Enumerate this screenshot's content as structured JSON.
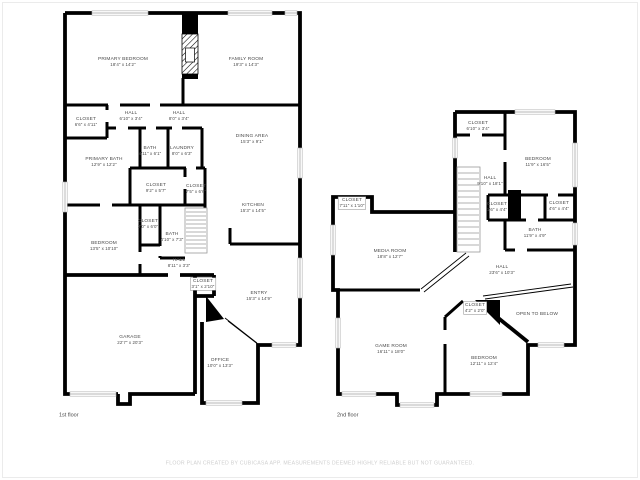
{
  "canvas": {
    "background": "#ffffff",
    "wall_color": "#000000",
    "label_color": "#4a4a4a",
    "footer_color": "#cfcfcf"
  },
  "footer": {
    "disclaimer": "FLOOR PLAN CREATED BY CUBICASA APP. MEASUREMENTS DEEMED HIGHLY RELIABLE BUT NOT GUARANTEED."
  },
  "floors": [
    {
      "id": "first-floor",
      "label": "1st floor",
      "label_pos": {
        "x": 59,
        "y": 412
      },
      "rooms": [
        {
          "name": "PRIMARY BEDROOM",
          "dims": "18'4\" x 14'2\"",
          "x": 123,
          "y": 62
        },
        {
          "name": "FAMILY ROOM",
          "dims": "19'3\" x 14'3\"",
          "x": 246,
          "y": 62
        },
        {
          "name": "CLOSET",
          "dims": "6'6\" x 4'11\"",
          "x": 86,
          "y": 122
        },
        {
          "name": "HALL",
          "dims": "6'10\" x 3'4\"",
          "x": 131,
          "y": 116
        },
        {
          "name": "HALL",
          "dims": "8'0\" x 3'4\"",
          "x": 179,
          "y": 116
        },
        {
          "name": "DINING AREA",
          "dims": "15'3\" x 9'1\"",
          "x": 252,
          "y": 139
        },
        {
          "name": "PRIMARY BATH",
          "dims": "12'9\" x 12'2\"",
          "x": 104,
          "y": 162
        },
        {
          "name": "BATH",
          "dims": "4'11\" x 6'1\"",
          "x": 150,
          "y": 151
        },
        {
          "name": "LAUNDRY",
          "dims": "8'0\" x 6'3\"",
          "x": 182,
          "y": 151
        },
        {
          "name": "CLOSET",
          "dims": "9'2\" x 5'7\"",
          "x": 156,
          "y": 188
        },
        {
          "name": "CLOSET",
          "dims": "7'5\" x 6'6\"",
          "x": 196,
          "y": 189
        },
        {
          "name": "KITCHEN",
          "dims": "15'3\" x 14'5\"",
          "x": 253,
          "y": 208
        },
        {
          "name": "BEDROOM",
          "dims": "13'5\" x 10'10\"",
          "x": 104,
          "y": 246
        },
        {
          "name": "CLOSET",
          "dims": "2'0\" x 6'0\"",
          "x": 148,
          "y": 224
        },
        {
          "name": "BATH",
          "dims": "4'10\" x 7'3\"",
          "x": 172,
          "y": 237
        },
        {
          "name": "HALL",
          "dims": "8'11\" x 3'3\"",
          "x": 179,
          "y": 263
        },
        {
          "name": "CLOSET",
          "dims": "3'1\" x 2'10\"",
          "x": 203,
          "y": 284,
          "boxed": true
        },
        {
          "name": "ENTRY",
          "dims": "15'3\" x 14'9\"",
          "x": 259,
          "y": 296
        },
        {
          "name": "GARAGE",
          "dims": "22'7\" x 20'3\"",
          "x": 130,
          "y": 340
        },
        {
          "name": "OFFICE",
          "dims": "10'0\" x 13'3\"",
          "x": 220,
          "y": 363
        }
      ]
    },
    {
      "id": "second-floor",
      "label": "2nd floor",
      "label_pos": {
        "x": 337,
        "y": 412
      },
      "rooms": [
        {
          "name": "CLOSET",
          "dims": "6'10\" x 3'4\"",
          "x": 478,
          "y": 126
        },
        {
          "name": "BEDROOM",
          "dims": "11'9\" x 16'5\"",
          "x": 538,
          "y": 162
        },
        {
          "name": "HALL",
          "dims": "9'10\" x 18'1\"",
          "x": 490,
          "y": 181
        },
        {
          "name": "CLOSET",
          "dims": "1'6\" x 4'4\"",
          "x": 497,
          "y": 207
        },
        {
          "name": "CLOSET",
          "dims": "4'6\" x 4'4\"",
          "x": 559,
          "y": 206
        },
        {
          "name": "BATH",
          "dims": "11'9\" x 4'9\"",
          "x": 535,
          "y": 233
        },
        {
          "name": "CLOSET",
          "dims": "7'11\" x 1'10\"",
          "x": 352,
          "y": 203,
          "boxed": true
        },
        {
          "name": "MEDIA ROOM",
          "dims": "18'8\" x 12'7\"",
          "x": 390,
          "y": 254
        },
        {
          "name": "HALL",
          "dims": "23'6\" x 10'3\"",
          "x": 502,
          "y": 270
        },
        {
          "name": "CLOSET",
          "dims": "4'2\" x 2'0\"",
          "x": 475,
          "y": 308,
          "boxed": true
        },
        {
          "name": "OPEN TO BELOW",
          "dims": "",
          "x": 537,
          "y": 314
        },
        {
          "name": "GAME ROOM",
          "dims": "16'11\" x 18'0\"",
          "x": 391,
          "y": 349
        },
        {
          "name": "BEDROOM",
          "dims": "12'11\" x 12'4\"",
          "x": 484,
          "y": 361
        }
      ]
    }
  ]
}
